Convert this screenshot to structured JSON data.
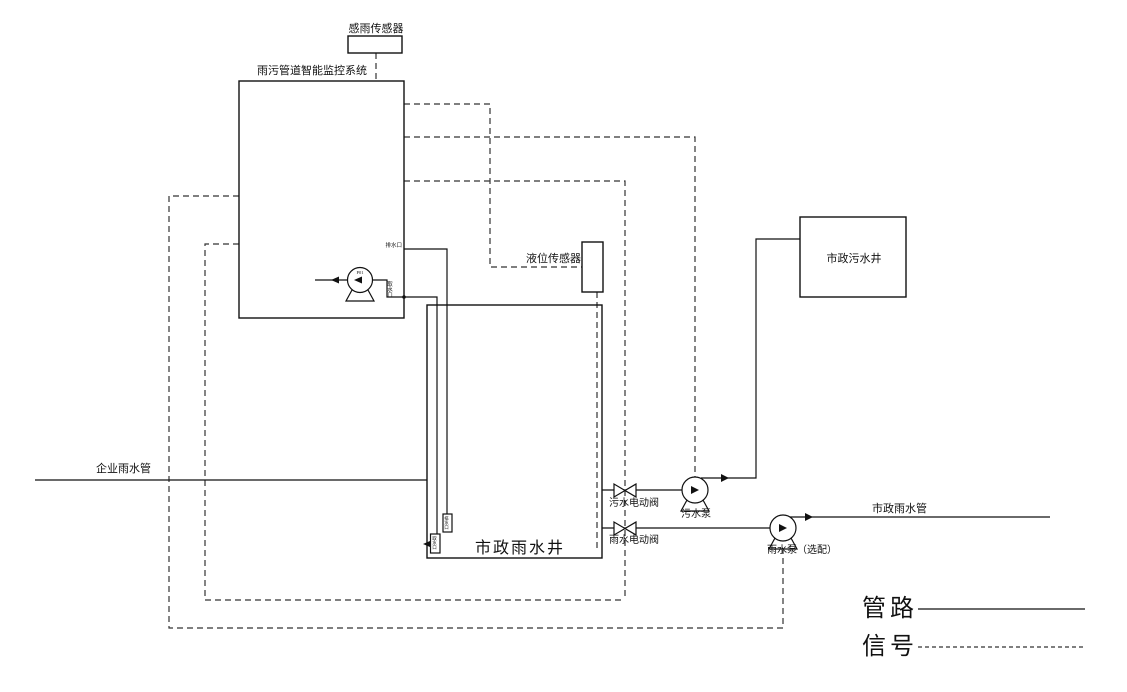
{
  "page": {
    "background": "#ffffff",
    "line_color": "#111111"
  },
  "labels": {
    "rain_sensor": "感雨传感器",
    "monitor_system": "雨污管道智能监控系统",
    "level_sensor": "液位传感器",
    "municipal_sewage_well": "市政污水井",
    "municipal_rain_well": "市政雨水井",
    "enterprise_rain_pipe": "企业雨水管",
    "sewage_valve": "污水电动阀",
    "sewage_pump": "污水泵",
    "rain_valve": "雨水电动阀",
    "rain_pump": "雨水泵（选配）",
    "municipal_rain_pipe": "市政雨水管",
    "pump_tag": "P01",
    "drain_port": "排水口",
    "intake_port": "取水口",
    "well_drain_port": "排水口",
    "well_intake_port": "取水口"
  },
  "legend": {
    "pipe": "管路",
    "signal": "信号"
  }
}
